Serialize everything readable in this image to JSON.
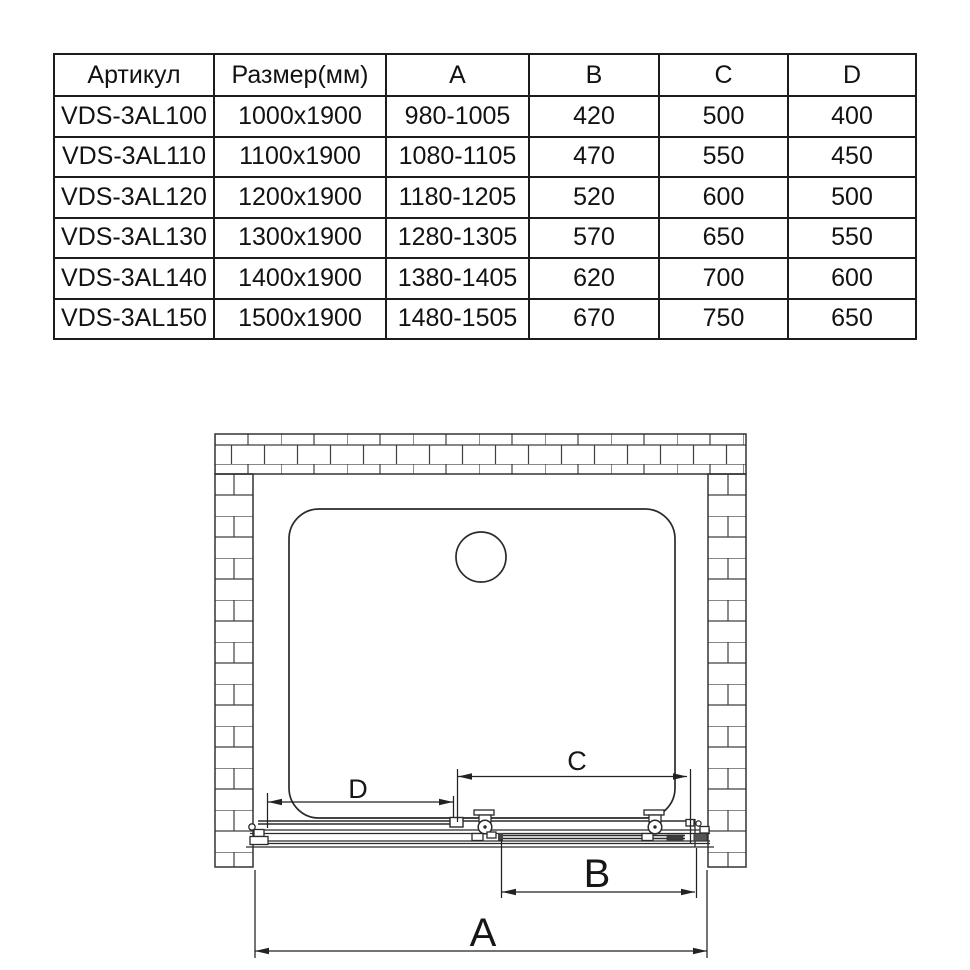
{
  "meta": {
    "background": "#ffffff",
    "ink": "#1c1c1c",
    "brick_line": "#3f3f3f",
    "hardware_fill": "#444444"
  },
  "table": {
    "headers": [
      "Артикул",
      "Размер(мм)",
      "A",
      "B",
      "C",
      "D"
    ],
    "rows": [
      [
        "VDS-3AL100",
        "1000x1900",
        "980-1005",
        "420",
        "500",
        "400"
      ],
      [
        "VDS-3AL110",
        "1100x1900",
        "1080-1105",
        "470",
        "550",
        "450"
      ],
      [
        "VDS-3AL120",
        "1200x1900",
        "1180-1205",
        "520",
        "600",
        "500"
      ],
      [
        "VDS-3AL130",
        "1300x1900",
        "1280-1305",
        "570",
        "650",
        "550"
      ],
      [
        "VDS-3AL140",
        "1400x1900",
        "1380-1405",
        "620",
        "700",
        "600"
      ],
      [
        "VDS-3AL150",
        "1500x1900",
        "1480-1505",
        "670",
        "750",
        "650"
      ]
    ]
  },
  "diagram": {
    "description": "top view installation drawing of sliding shower door in alcove",
    "labels": {
      "a": "A",
      "b": "B",
      "c": "C",
      "d": "D"
    }
  }
}
